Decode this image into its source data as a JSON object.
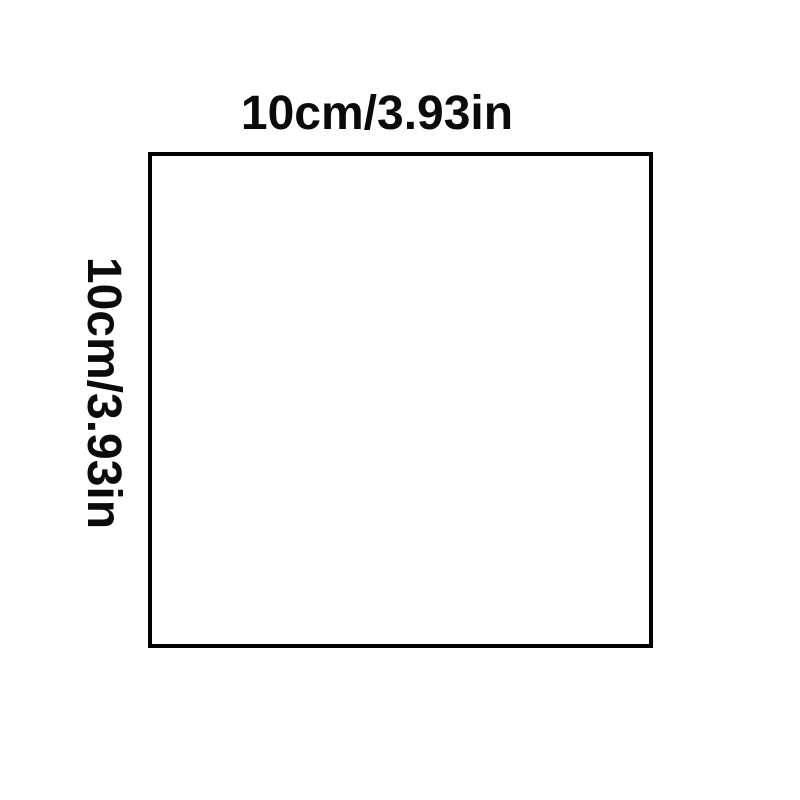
{
  "diagram": {
    "type": "product-dimension-diagram",
    "background_color": "#ffffff",
    "line_color": "#000000",
    "text_color": "#0a0a0a",
    "shape": {
      "kind": "square",
      "width_label": "10cm/3.93in",
      "height_label": "10cm/3.93in"
    }
  }
}
